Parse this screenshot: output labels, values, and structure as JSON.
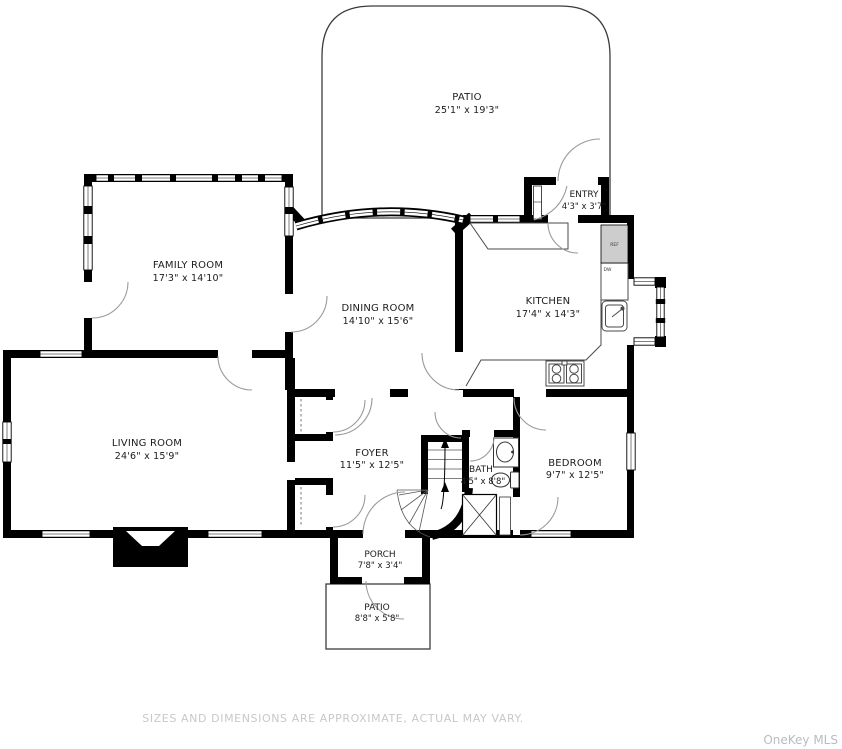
{
  "floorplan": {
    "rooms": {
      "patio_top": {
        "name": "PATIO",
        "dims": "25'1\" x 19'3\""
      },
      "entry": {
        "name": "ENTRY",
        "dims": "4'3\" x 3'7\""
      },
      "family_room": {
        "name": "FAMILY ROOM",
        "dims": "17'3\" x 14'10\""
      },
      "dining_room": {
        "name": "DINING ROOM",
        "dims": "14'10\" x 15'6\""
      },
      "kitchen": {
        "name": "KITCHEN",
        "dims": "17'4\" x 14'3\""
      },
      "living_room": {
        "name": "LIVING ROOM",
        "dims": "24'6\" x 15'9\""
      },
      "foyer": {
        "name": "FOYER",
        "dims": "11'5\" x 12'5\""
      },
      "bath": {
        "name": "BATH",
        "dims": "4'5\" x 8'8\""
      },
      "bedroom": {
        "name": "BEDROOM",
        "dims": "9'7\" x 12'5\""
      },
      "porch": {
        "name": "PORCH",
        "dims": "7'8\" x 3'4\""
      },
      "patio_bottom": {
        "name": "PATIO",
        "dims": "8'8\" x 5'8\""
      }
    },
    "appliances": {
      "refrigerator_label": "REF",
      "dishwasher_label": "DW"
    },
    "footer_text": "SIZES AND DIMENSIONS ARE APPROXIMATE, ACTUAL MAY VARY.",
    "watermark_text": "OneKey MLS",
    "colors": {
      "wall": "#000000",
      "label_text": "#1c1c1c",
      "door_arc": "#9a9a9a",
      "fixture_line": "#4a4a4a",
      "refrigerator_fill": "#cdcdcd",
      "footer_text": "#c8c8c8",
      "watermark_text": "#b8bcbf",
      "background": "#ffffff"
    }
  }
}
